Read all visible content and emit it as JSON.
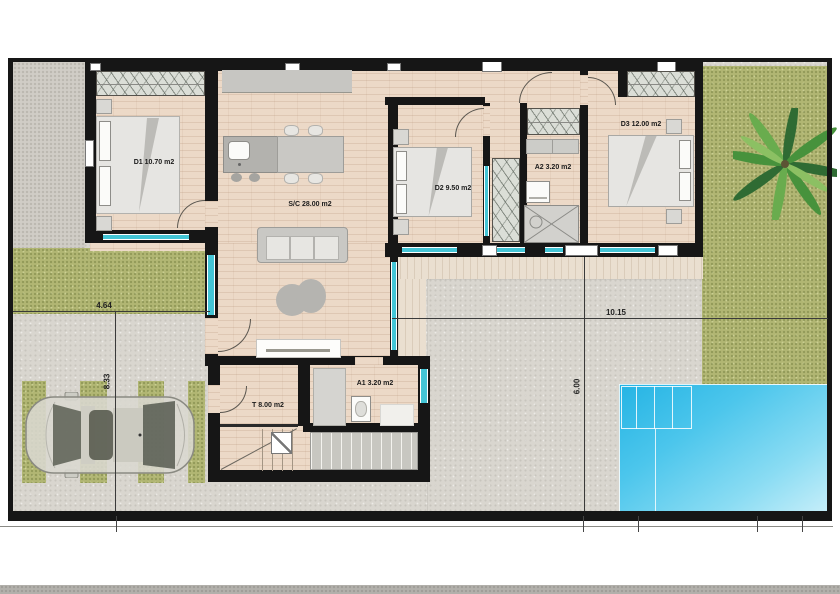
{
  "plan": {
    "rooms": [
      {
        "id": "d1",
        "label": "D1 10.70 m2"
      },
      {
        "id": "sc",
        "label": "S/C 28.00 m2"
      },
      {
        "id": "d2",
        "label": "D2 9.50 m2"
      },
      {
        "id": "a2",
        "label": "A2 3.20 m2"
      },
      {
        "id": "d3",
        "label": "D3 12.00 m2"
      },
      {
        "id": "t",
        "label": "T 8.00 m2"
      },
      {
        "id": "a1",
        "label": "A1 3.20 m2"
      }
    ],
    "dims": {
      "left_w": "4.64",
      "left_h": "8.33",
      "right_w": "10.15",
      "right_h": "6.00"
    },
    "colors": {
      "wall": "#161616",
      "floor": "#ecd9c7",
      "terrace": "#eadfd0",
      "grass": "#b1b673",
      "concrete": "#d9d6cf",
      "pool": "#35bce8",
      "window": "#43c5d6"
    },
    "features": [
      "double-bed",
      "wardrobe",
      "kitchen-island",
      "dining-table",
      "sofa",
      "rug",
      "tv-unit",
      "shower",
      "washbasin",
      "washing-machine",
      "stairs",
      "pergola-deck",
      "car",
      "palm-tree",
      "swimming-pool",
      "parking-stripes"
    ]
  }
}
